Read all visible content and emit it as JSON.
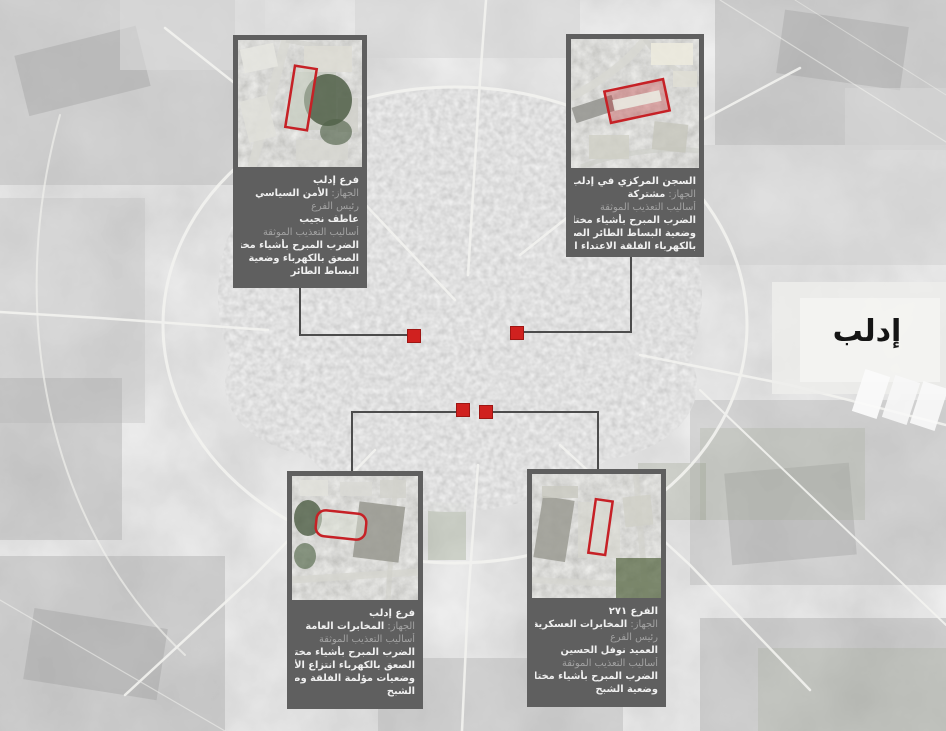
{
  "map": {
    "city_label": "إدلب",
    "marker_count": 4,
    "colors": {
      "accent_red": "#d0211f",
      "inset_outline_red": "#c62126",
      "callout_bg": "#5f5f5f",
      "leader_line": "#4c4c4c",
      "map_base": "#c6c6c6",
      "caption_label_gray": "#a2a2a2",
      "caption_text_white": "#f0f0f0",
      "city_label_color": "#151515"
    }
  },
  "callouts": [
    {
      "position": "top-left",
      "title": "فرع إدلب",
      "agency_label": "الجهاز:",
      "agency": "الأمن السياسي",
      "head_label": "رئيس الفرع",
      "head_name": "عاطف نجيب",
      "methods_label": "أساليب التعذيب الموثقة",
      "methods_lines": [
        "الضرب المبرح بأشياء مختلفة",
        "الصعق بالكهرباء وضعية",
        "البساط الطائر"
      ]
    },
    {
      "position": "top-right",
      "title": "السجن المركزي في إدلب",
      "agency_label": "الجهاز:",
      "agency": "مشتركة",
      "methods_label": "أساليب التعذيب الموثقة",
      "methods_lines": [
        "الضرب المبرح بأشياء مختلفة",
        "وضعية البساط الطائر الصعق",
        "بالكهرباء الفلقة الاعتداء الجنسي"
      ]
    },
    {
      "position": "bottom-left",
      "title": "فرع إدلب",
      "agency_label": "الجهاز:",
      "agency": "المخابرات العامة",
      "methods_label": "أساليب التعذيب الموثقة",
      "methods_lines": [
        "الضرب المبرح بأشياء مختلفة",
        "الصعق بالكهرباء انتزاع الأظافر",
        "وضعيات مؤلمة الفلقة وضعية",
        "الشبح"
      ]
    },
    {
      "position": "bottom-right",
      "title": "الفرع ٢٧١",
      "agency_label": "الجهاز:",
      "agency": "المخابرات العسكرية",
      "head_label": "رئيس الفرع",
      "head_name": "العميد نوفل الحسين",
      "methods_label": "أساليب التعذيب الموثقة",
      "methods_lines": [
        "الضرب المبرح بأشياء مختلفة",
        "وضعية الشبح"
      ]
    }
  ]
}
